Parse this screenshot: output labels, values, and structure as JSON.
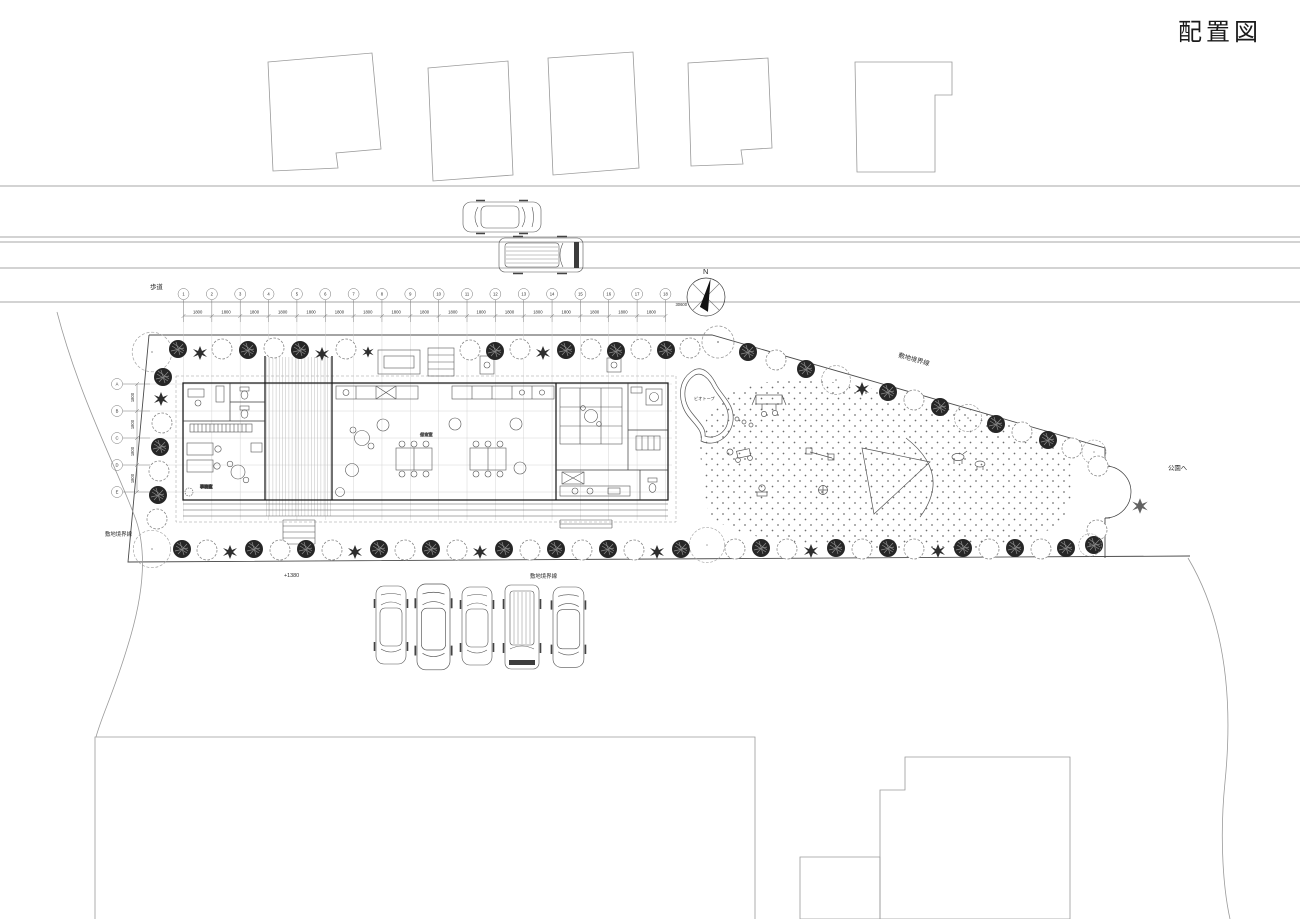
{
  "title": "配置図",
  "compass": {
    "north_label": "N"
  },
  "road": {
    "sidewalk_label": "歩道"
  },
  "boundaries": {
    "northeast_label": "敷地境界線",
    "southwest_label": "敷地境界線",
    "south_label": "敷地境界線"
  },
  "site": {
    "to_park_label": "公園へ",
    "level_mark": "+1380",
    "pond_label": "ビオトープ",
    "office_label": "事務室",
    "playroom_label": "保育室"
  },
  "grid": {
    "x_labels": [
      "1",
      "2",
      "3",
      "4",
      "5",
      "6",
      "7",
      "8",
      "9",
      "10",
      "11",
      "12",
      "13",
      "14",
      "15",
      "16",
      "17",
      "18"
    ],
    "x_bay_dim": "1800",
    "x_total_dim": "30600",
    "y_labels": [
      "A",
      "B",
      "C",
      "D",
      "E"
    ],
    "y_bay_dim": "1800"
  }
}
